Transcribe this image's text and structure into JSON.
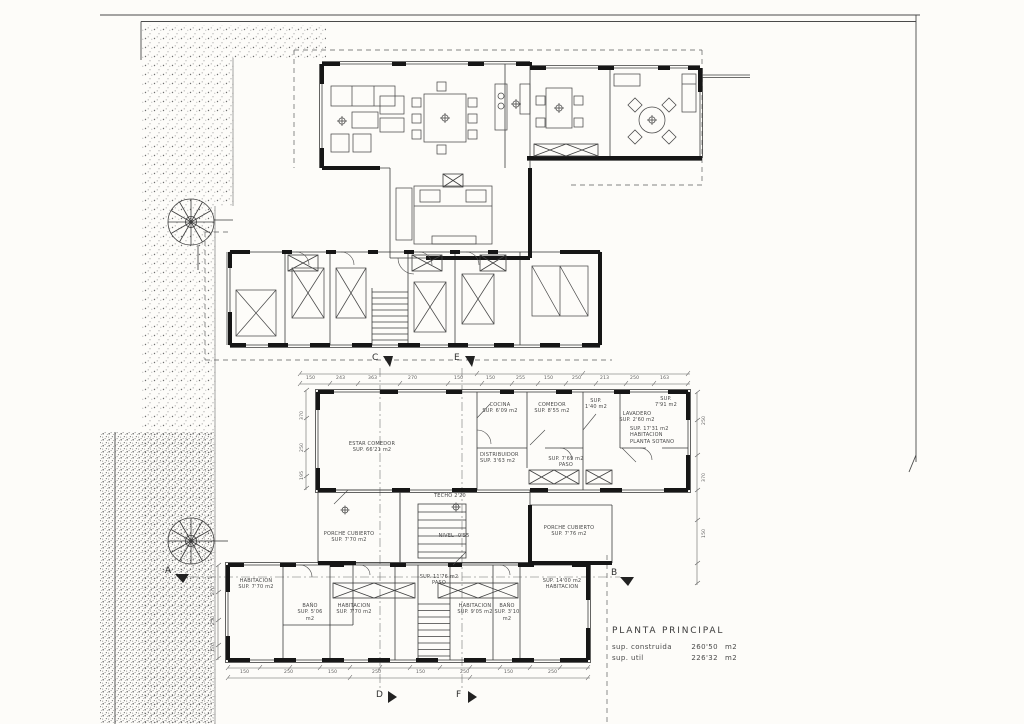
{
  "title_block": {
    "title": "PLANTA PRINCIPAL",
    "construida_label": "sup. construida",
    "construida_value": "260'50",
    "construida_unit": "m2",
    "util_label": "sup. util",
    "util_value": "226'32",
    "util_unit": "m2"
  },
  "markers": {
    "a": "A",
    "b": "B",
    "c": "C",
    "d": "D",
    "e": "E",
    "f": "F"
  },
  "rooms": {
    "estar": "ESTAR COMEDOR\nSUP. 66'21 m2",
    "cocina": "COCINA\nSUP. 6'09 m2",
    "comedor": "COMEDOR\nSUP. 8'55 m2",
    "despensa": "SUP.\n1'40 m2",
    "lavadero": "LAVADERO\nSUP. 2'60 m2",
    "terraza": "SUP.\n7'91 m2",
    "habitacion_sotano": "SUP. 17'31 m2\nHABITACION\nPLANTA SOTANO",
    "distribuidor": "DISTRIBUIDOR\nSUP. 3'63 m2",
    "paso_1": "SUP. 7'69 m2\nPASO",
    "porche_izq": "PORCHE CUBIERTO\nSUP. 7'70 m2",
    "porche_der": "PORCHE CUBIERTO\nSUP. 7'76 m2",
    "habitacion_1": "HABITACION\nSUP. 7'70 m2",
    "bano_1": "BAÑO\nSUP. 5'06 m2",
    "habitacion_2": "HABITACION\nSUP. 7'70 m2",
    "paso_2": "SUP. 11'76 m2\nPASO",
    "habitacion_3": "HABITACION\nSUP. 9'05 m2",
    "bano_2": "BAÑO\nSUP. 3'10 m2",
    "habitacion_4": "SUP. 14'00 m2\nHABITACION"
  },
  "annotations": {
    "techo": "TECHO 2'20",
    "nivel": "NIVEL -0'55"
  },
  "dimensions": {
    "top": [
      "150",
      "243",
      "363",
      "270",
      "150",
      "150",
      "255",
      "150",
      "250",
      "213",
      "250",
      "163"
    ],
    "bottom": [
      "150",
      "250",
      "150",
      "250",
      "150",
      "250",
      "150",
      "250"
    ],
    "left": [
      "370",
      "250",
      "195"
    ],
    "left_lower": [
      "270",
      "250",
      "170"
    ],
    "right": [
      "250",
      "370",
      "150"
    ]
  },
  "colors": {
    "paper": "#fdfcf9",
    "ink": "#1c1c1c",
    "thin_line": "#3d3d3d",
    "stipple": "#6e6e6e"
  }
}
